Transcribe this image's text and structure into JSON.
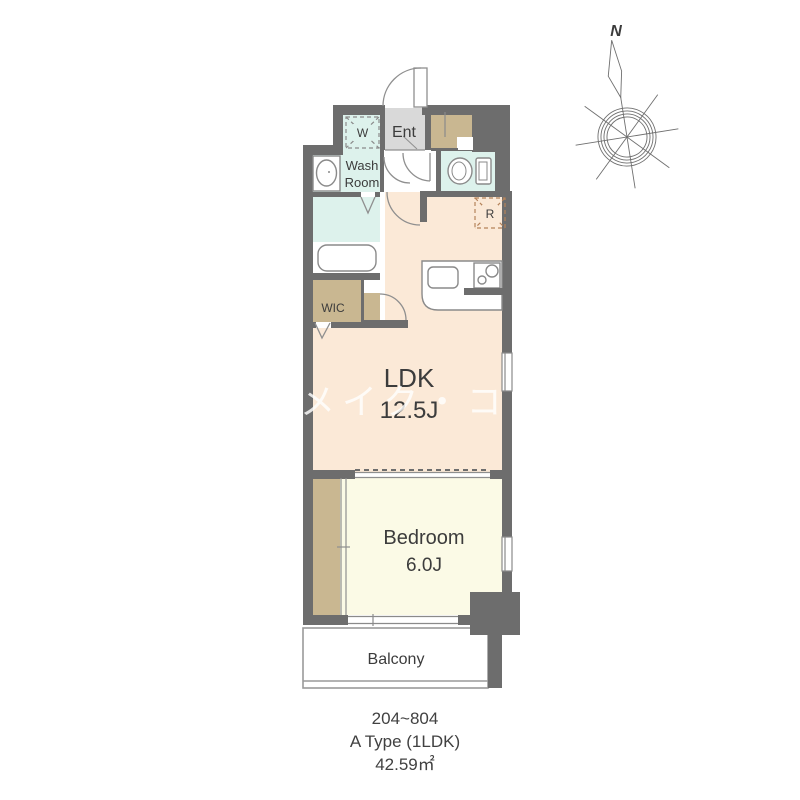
{
  "rooms": {
    "ldk": {
      "label": "LDK",
      "size": "12.5J"
    },
    "bedroom": {
      "label": "Bedroom",
      "size": "6.0J"
    },
    "balcony": {
      "label": "Balcony"
    },
    "washroom": {
      "label_line1": "Wash",
      "label_line2": "Room"
    },
    "entrance": {
      "label": "Ent"
    },
    "wic": {
      "label": "WIC"
    },
    "washer_space": {
      "label": "W"
    },
    "refrigerator_space": {
      "label": "R"
    }
  },
  "compass": {
    "label": "N"
  },
  "watermark": {
    "text": "メイク・コーポレー"
  },
  "caption": {
    "units": "204~804",
    "type": "A Type (1LDK)",
    "area": "42.59㎡"
  },
  "colors": {
    "wall": "#6d6d6d",
    "ldk_floor": "#fbe9d7",
    "bedroom_floor": "#fbfae6",
    "wet_area_floor": "#ddf2ec",
    "storage_fill": "#c9b791",
    "entrance_floor": "#d9d9d9",
    "line": "#8a8a8a",
    "text": "#3c3c3c"
  }
}
